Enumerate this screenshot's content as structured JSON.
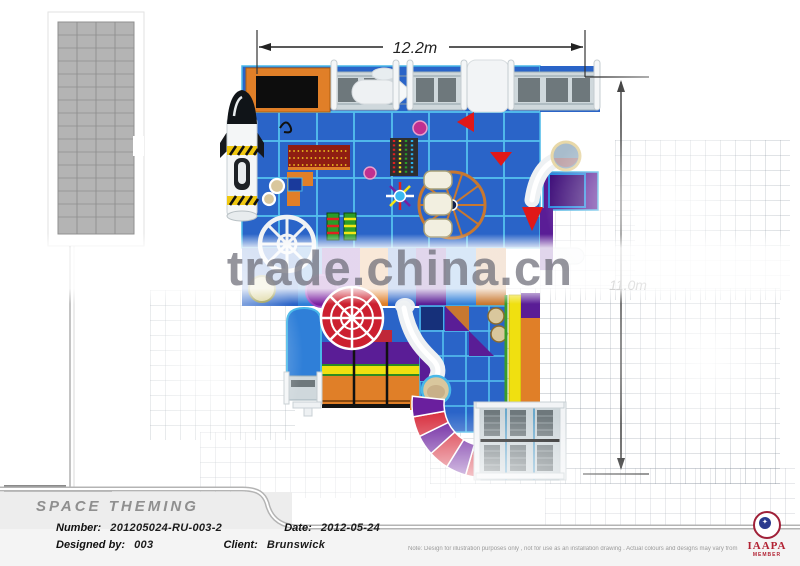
{
  "watermark": {
    "text": "trade.china.cn"
  },
  "dimensions": {
    "width": "12.2m",
    "height": "11.0m"
  },
  "title_block": {
    "title": "SPACE THEMING",
    "number_label": "Number:",
    "number_value": "201205024-RU-003-2",
    "date_label": "Date:",
    "date_value": "2012-05-24",
    "designed_by_label": "Designed by:",
    "designed_by_value": "003",
    "client_label": "Client:",
    "client_value": "Brunswick",
    "disclaimer": "Note: Design for illustration purposes only , not for use as an installation drawing . Actual colours and designs may vary from those shown ."
  },
  "logo": {
    "name": "IAAPA",
    "member": "MEMBER",
    "spark": "✦"
  },
  "plan": {
    "description": "Space-themed indoor playground floor plan, top view",
    "elements": [
      "rocket-tower",
      "trampoline-ball-pit",
      "grated-wall-panels",
      "tube-bridge",
      "spinner-star",
      "climbing-block",
      "ferris-wheel",
      "tube-slide-exit-ring",
      "direction-arrows",
      "white-spoke-wheel",
      "roller-bars",
      "carousel-spiral-wheel",
      "wave-slide-lanes",
      "spiral-tube-slide",
      "bongo-drums",
      "curved-segment-slide",
      "ball-pool-deck",
      "tiled-walkway"
    ],
    "colors": {
      "platform_blue": "#2a64c8",
      "grid_line_blue": "#52c0ee",
      "accent_orange": "#e07f28",
      "accent_purple": "#5a1d96",
      "accent_red": "#d83040",
      "accent_yellow": "#f0e010",
      "accent_green": "#3a9c28",
      "deck_gray": "#cdd6da",
      "tube_white": "#f2f4f6",
      "tan": "#d9c79d"
    }
  }
}
